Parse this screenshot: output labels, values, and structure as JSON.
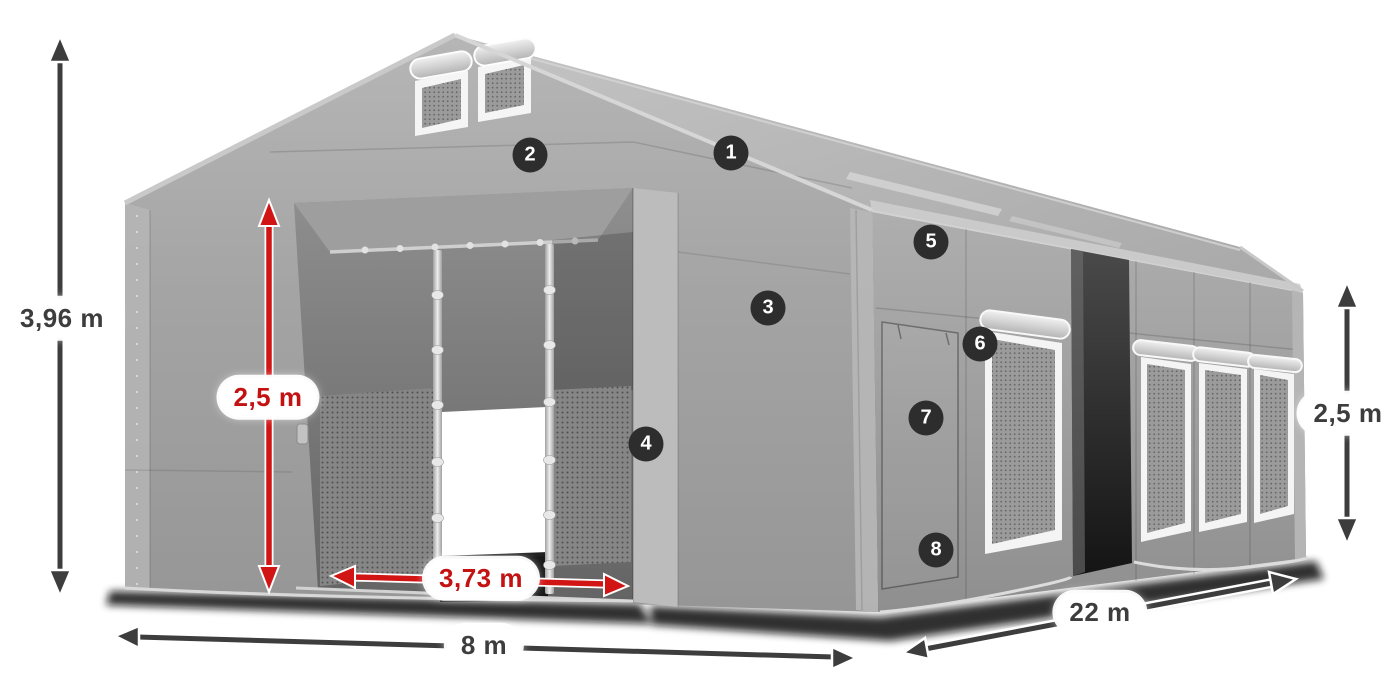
{
  "diagram": {
    "type": "tent-dimension-diagram",
    "colors": {
      "dimension_red": "#d11414",
      "dimension_dark": "#3d3d3d",
      "marker_background": "#2d2d2d",
      "marker_text": "#ffffff",
      "tent_gray": "#a6a6a6"
    }
  },
  "labels": {
    "total_height": "3,96 m",
    "entrance_height": "2,5 m",
    "entrance_width": "3,73 m",
    "width": "8 m",
    "length": "22 m",
    "side_height": "2,5 m"
  },
  "markers": {
    "m1": "1",
    "m2": "2",
    "m3": "3",
    "m4": "4",
    "m5": "5",
    "m6": "6",
    "m7": "7",
    "m8": "8"
  }
}
